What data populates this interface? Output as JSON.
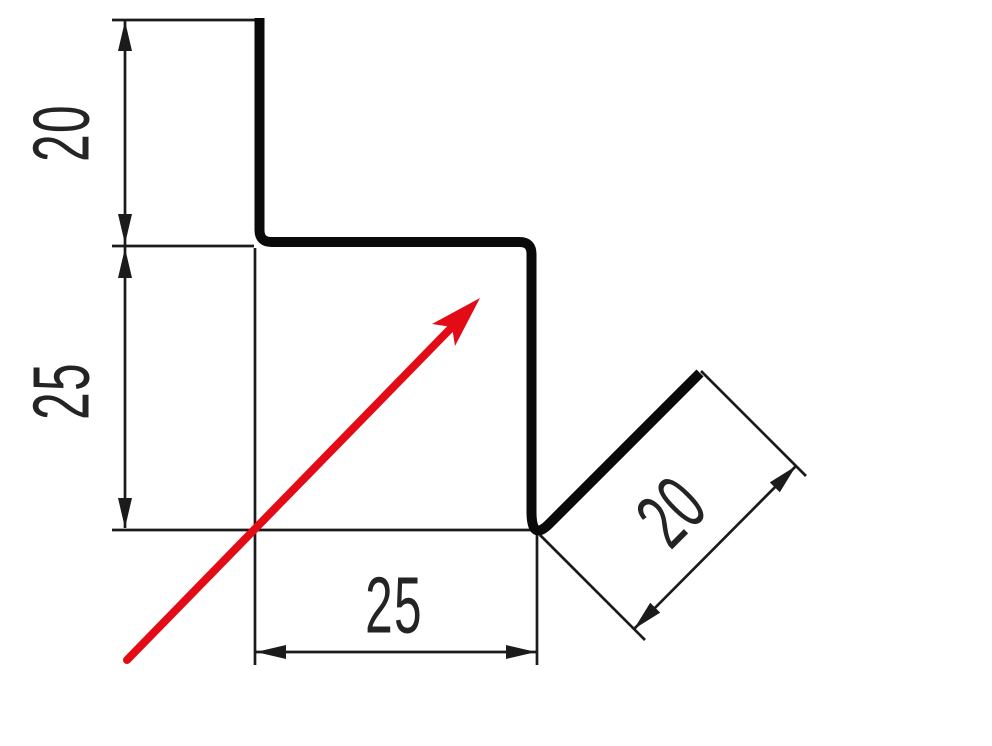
{
  "document": {
    "type": "technical dimension drawing",
    "subject": "sheet metal Z-profile cross-section with 45-degree flange"
  },
  "colors": {
    "background": "#ffffff",
    "line": "#1b1b1b",
    "profile": "#0a0a0a",
    "accent_red": "#e30b16"
  },
  "dimensions": [
    {
      "label": "20",
      "placement": "top-left vertical"
    },
    {
      "label": "25",
      "placement": "left vertical"
    },
    {
      "label": "25",
      "placement": "bottom horizontal"
    },
    {
      "label": "20",
      "placement": "diagonal flange"
    }
  ],
  "icons": {
    "direction_arrow": "red 45-degree arrow pointing up-right"
  }
}
